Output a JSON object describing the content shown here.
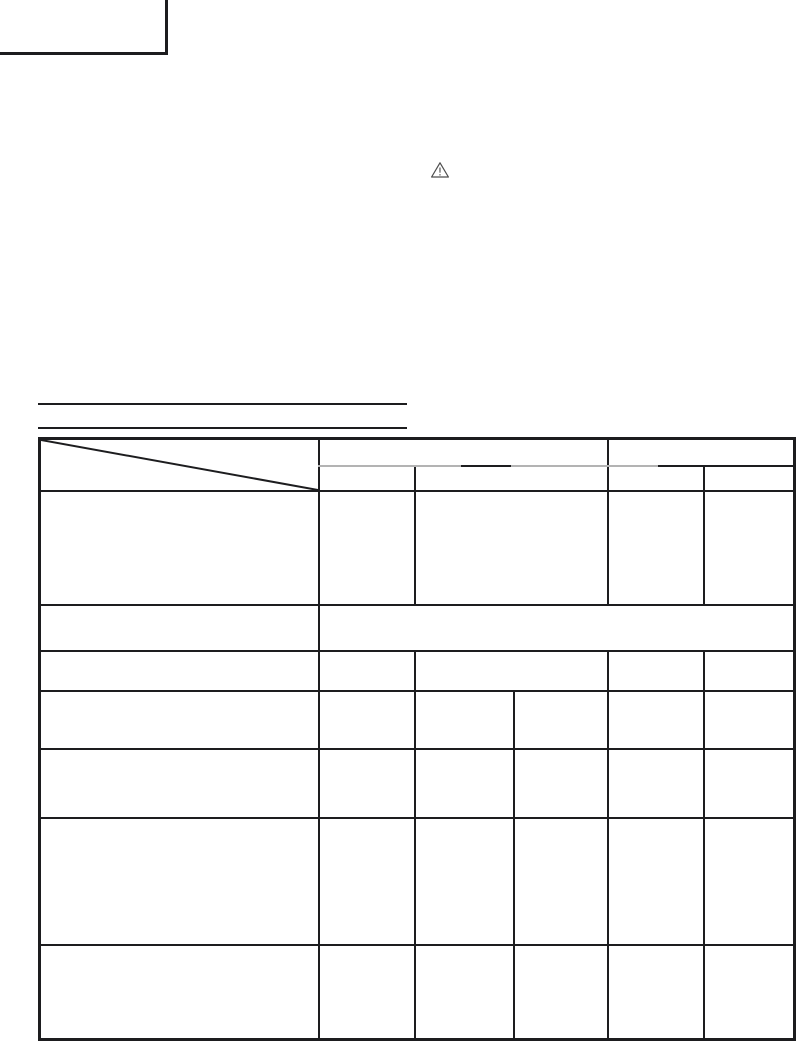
{
  "page": {
    "background_color": "#ffffff",
    "line_color": "#1d1d1f",
    "light_line_color": "#b3b3b3"
  },
  "warning_icon": {
    "name": "warning-triangle-icon",
    "glyph": "!"
  },
  "headings": {
    "underline_count": 2
  },
  "table": {
    "corner_cell_style": "diagonal-slash",
    "header_row_1": [
      "",
      "",
      ""
    ],
    "header_row_2": [
      "",
      "",
      "",
      ""
    ],
    "rows": [
      [
        "",
        "",
        "",
        "",
        ""
      ],
      [
        "",
        ""
      ],
      [
        "",
        "",
        "",
        "",
        ""
      ],
      [
        "",
        "",
        "",
        "",
        "",
        ""
      ],
      [
        "",
        "",
        "",
        "",
        "",
        ""
      ],
      [
        "",
        "",
        "",
        "",
        "",
        ""
      ],
      [
        "",
        "",
        "",
        "",
        "",
        ""
      ]
    ]
  }
}
